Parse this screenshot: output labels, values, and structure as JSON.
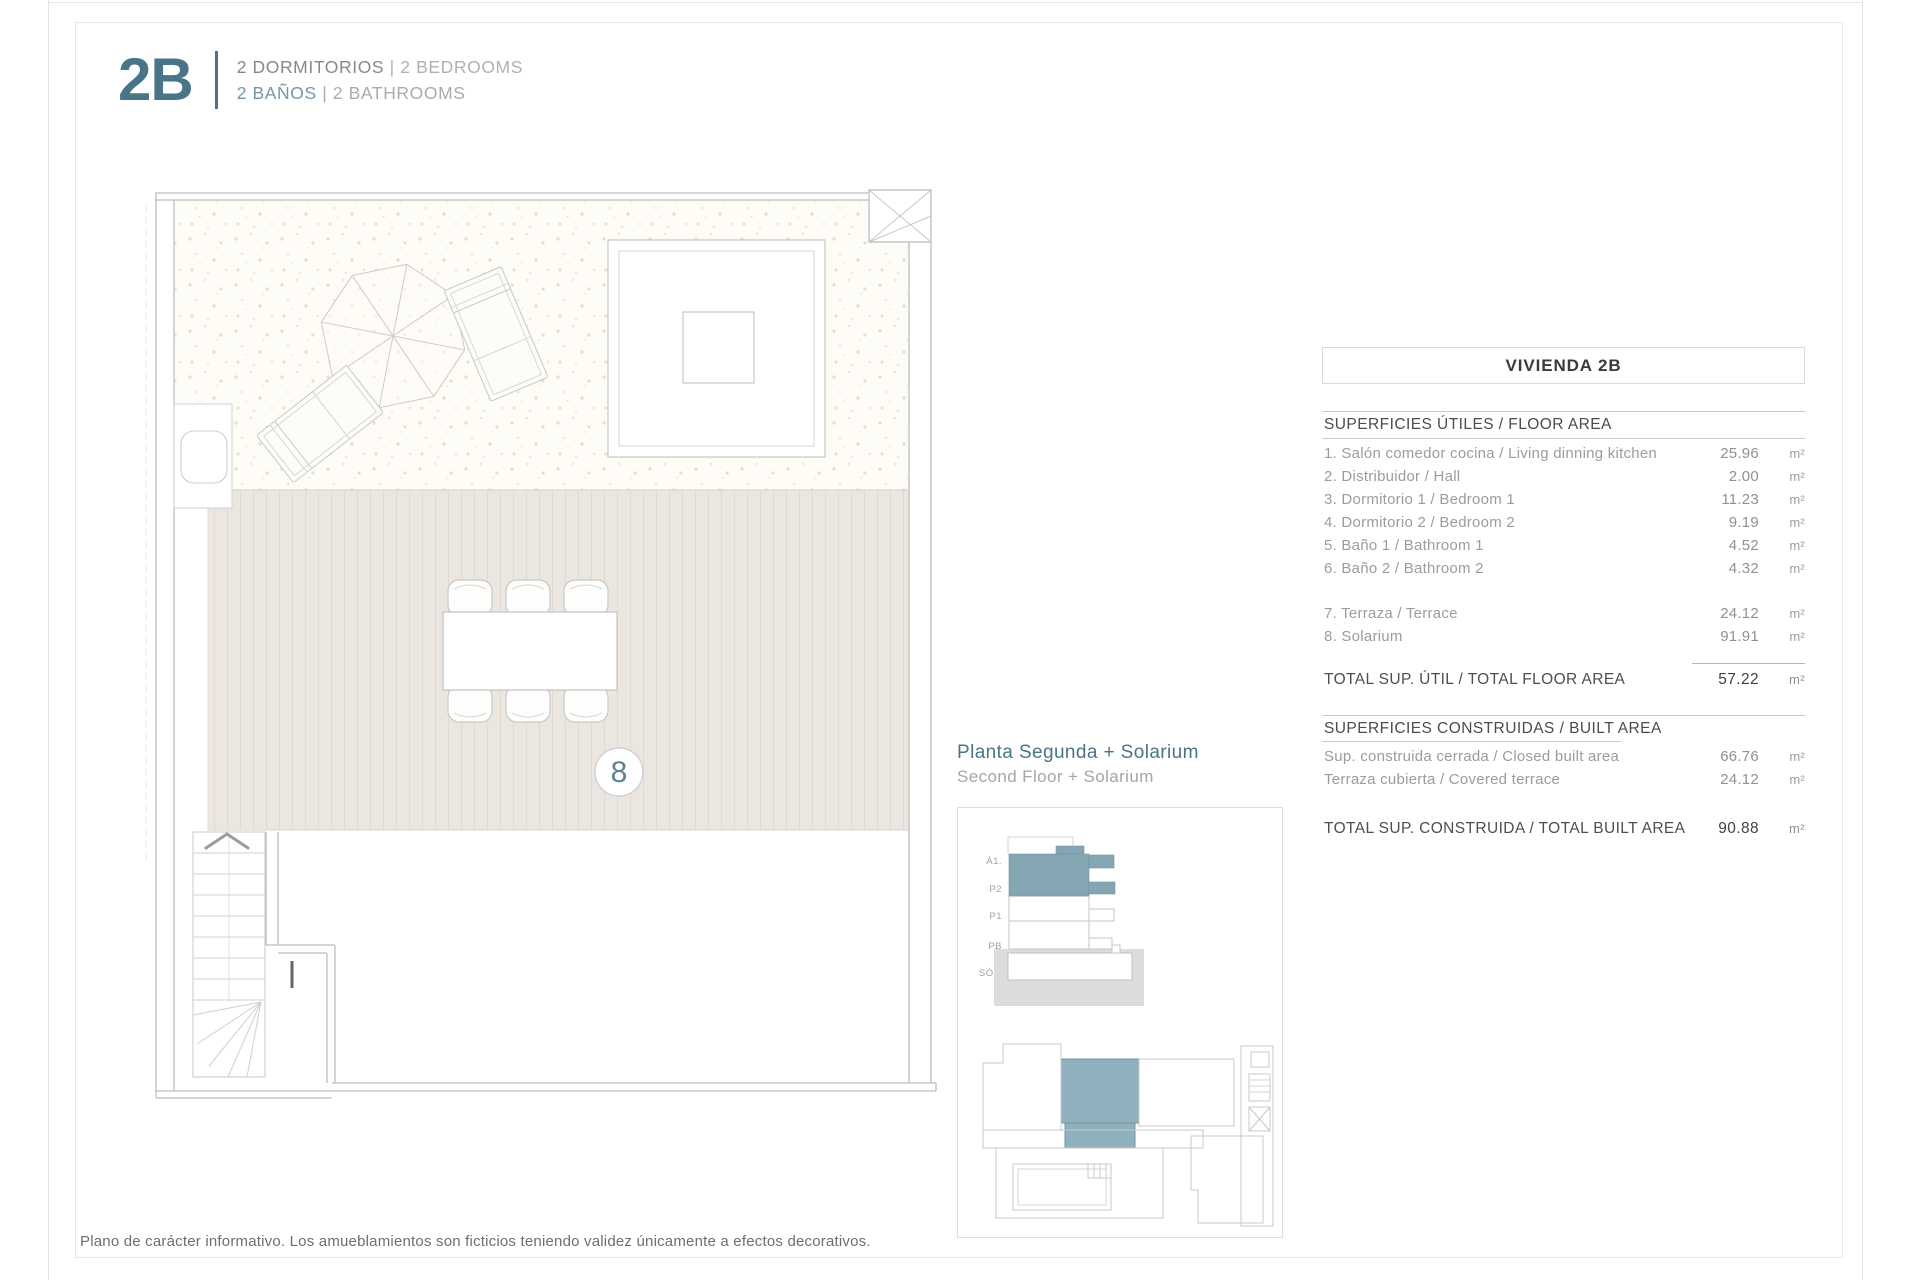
{
  "header": {
    "unit_code": "2B",
    "line1": {
      "es": "2 DORMITORIOS",
      "sep": "|",
      "en": "2 BEDROOMS"
    },
    "line2": {
      "es": "2 BAÑOS",
      "sep": "|",
      "en": "2 BATHROOMS"
    }
  },
  "plan": {
    "room_number": "8"
  },
  "inset": {
    "title_es": "Planta Segunda + Solarium",
    "title_en": "Second Floor + Solarium",
    "floor_labels": [
      "Á1.",
      "P2",
      "P1",
      "PB",
      "SÓT."
    ]
  },
  "table": {
    "title": "VIVIENDA 2B",
    "floor_area": {
      "header": "SUPERFICIES ÚTILES / FLOOR AREA",
      "rows": [
        {
          "label": "1. Salón comedor cocina / Living dinning kitchen",
          "value": "25.96",
          "unit": "m²"
        },
        {
          "label": "2. Distribuidor / Hall",
          "value": "2.00",
          "unit": "m²"
        },
        {
          "label": "3. Dormitorio 1 / Bedroom 1",
          "value": "11.23",
          "unit": "m²"
        },
        {
          "label": "4. Dormitorio 2 / Bedroom 2",
          "value": "9.19",
          "unit": "m²"
        },
        {
          "label": "5. Baño 1 / Bathroom 1",
          "value": "4.52",
          "unit": "m²"
        },
        {
          "label": "6. Baño 2 / Bathroom 2",
          "value": "4.32",
          "unit": "m²"
        }
      ],
      "rows_outdoor": [
        {
          "label": "7. Terraza / Terrace",
          "value": "24.12",
          "unit": "m²"
        },
        {
          "label": "8. Solarium",
          "value": "91.91",
          "unit": "m²"
        }
      ],
      "total": {
        "label": "TOTAL SUP. ÚTIL / TOTAL FLOOR AREA",
        "value": "57.22",
        "unit": "m²"
      }
    },
    "built_area": {
      "header": "SUPERFICIES CONSTRUIDAS / BUILT AREA",
      "rows": [
        {
          "label": "Sup. construida cerrada / Closed built area",
          "value": "66.76",
          "unit": "m²"
        },
        {
          "label": "Terraza cubierta / Covered terrace",
          "value": "24.12",
          "unit": "m²"
        }
      ],
      "total": {
        "label": "TOTAL SUP. CONSTRUIDA /  TOTAL BUILT AREA",
        "value": "90.88",
        "unit": "m²"
      }
    }
  },
  "footer": {
    "disclaimer": "Plano de carácter informativo. Los amueblamientos son ficticios teniendo validez únicamente a efectos decorativos."
  },
  "colors": {
    "accent_teal": "#4a7488",
    "highlight_fill": "#8fb0bd",
    "section_fill": "#84a5b2",
    "line_gray": "#c9c9c9",
    "text_dark": "#3b3b3b",
    "text_gray": "#9c9c9c",
    "deck_beige": "#ebe6df",
    "stipple_cream": "#fdfcf7"
  }
}
